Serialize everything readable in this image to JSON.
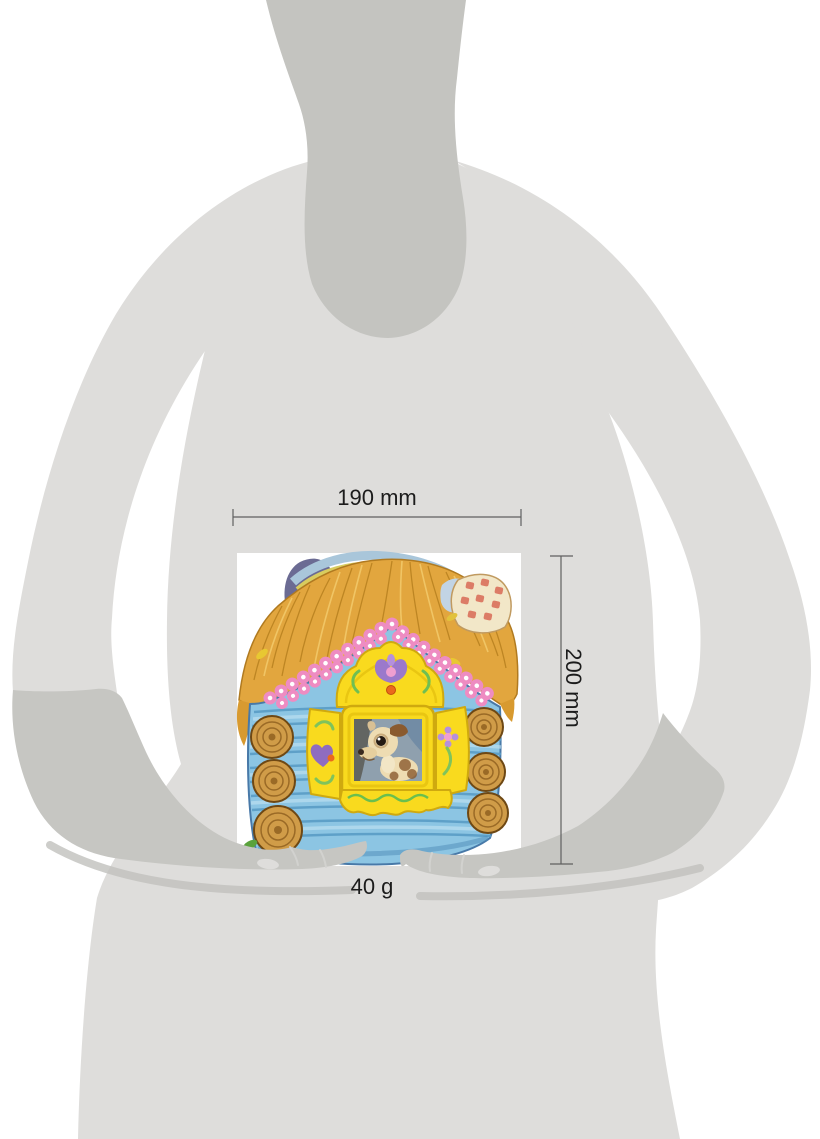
{
  "labels": {
    "width": "190 mm",
    "height": "200 mm",
    "weight": "40 g"
  },
  "measurements": {
    "width_mm": 190,
    "height_mm": 200,
    "weight_g": 40
  },
  "colors": {
    "body_silhouette": "#dedddb",
    "neck_shadow": "#c4c4c0",
    "forearm": "#c6c6c2",
    "hand_shadow": "#c0c0bd",
    "nail_highlight": "#dedddb",
    "dimension_line": "#606060",
    "label_text": "#1c1c1c",
    "product_background": "#ffffff",
    "wall_blue": "#8cc5e3",
    "wall_outline": "#4879a8",
    "log_line_blue": "#5a9dc6",
    "roof_straw": "#e2a63e",
    "straw_dark": "#b7801f",
    "straw_light": "#f2c96a",
    "trim_pink": "#ee8cc2",
    "frame_yellow": "#f9da1e",
    "frame_outline": "#cfa90f",
    "log_wood": "#d09c48",
    "log_ring": "#9a6a26",
    "accent_green": "#7fc35c",
    "accent_purple": "#9b79cb",
    "accent_pink": "#ef9fd0",
    "accent_orange": "#ea6a1c",
    "back_page_purple": "#6b6b93",
    "page_edge_blue": "#a9c6da",
    "page_edge_olive": "#d8cc5e",
    "chimney_cream": "#f2e7c8",
    "chimney_check_red": "#d96a55",
    "puppy_cream": "#eedcb2",
    "puppy_brown": "#8a5a2e"
  }
}
